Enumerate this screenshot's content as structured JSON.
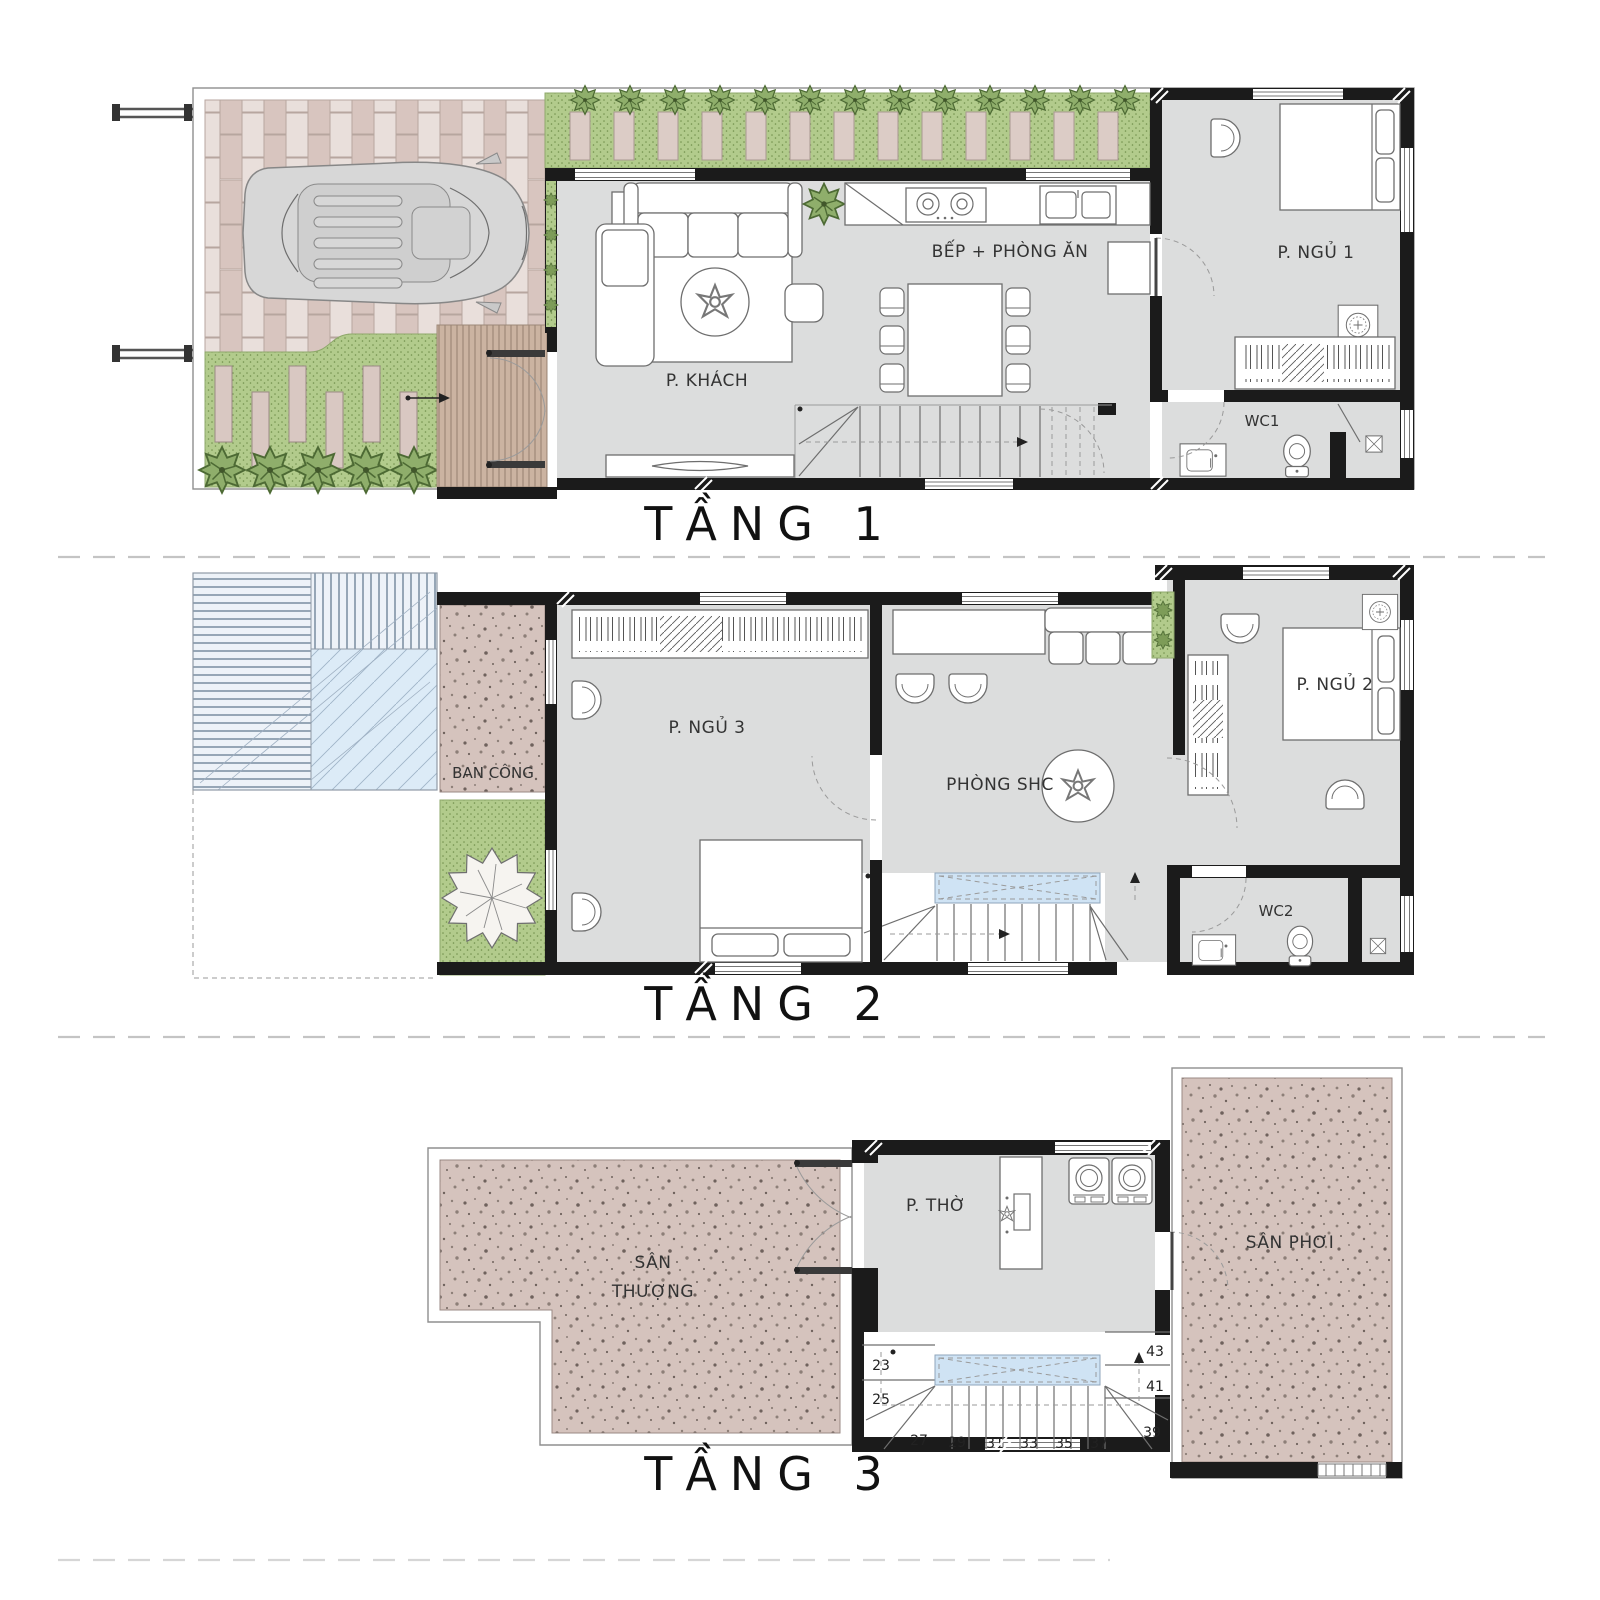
{
  "sheet": {
    "type": "architectural floor plan",
    "floors_count": 3
  },
  "floors": [
    {
      "title": "TẦNG 1",
      "rooms": {
        "living": "P. KHÁCH",
        "kitchen": "BẾP + PHÒNG ĂN",
        "bedroom1": "P. NGỦ 1",
        "wc1": "WC1"
      }
    },
    {
      "title": "TẦNG 2",
      "rooms": {
        "balcony": "BAN CÔNG",
        "bedroom3": "P. NGỦ 3",
        "family": "PHÒNG SHC",
        "bedroom2": "P. NGỦ 2",
        "wc2": "WC2"
      }
    },
    {
      "title": "TẦNG 3",
      "rooms": {
        "terrace1": "SÂN",
        "terrace2": "THƯỢNG",
        "worship": "P. THỜ",
        "drying": "SÂN PHƠI"
      },
      "stair_numbers": [
        "23",
        "25",
        "27",
        "29",
        "31",
        "33",
        "35",
        "37",
        "39",
        "41",
        "43"
      ]
    }
  ],
  "palette": {
    "wall": "#1b1b1b",
    "interior_floor": "#dcdddd",
    "brick_a": "#d8c5bf",
    "brick_b": "#e9dfdb",
    "lawn_green": "#b2cb8c",
    "tree_green": "#8fae6b",
    "paver_pink": "#dcccc6",
    "speckle_base": "#d5c3bd",
    "deck_wood": "#cbb3a1",
    "skylight_blue": "#cfe3f4",
    "glass_blue": "#dcebf7"
  }
}
